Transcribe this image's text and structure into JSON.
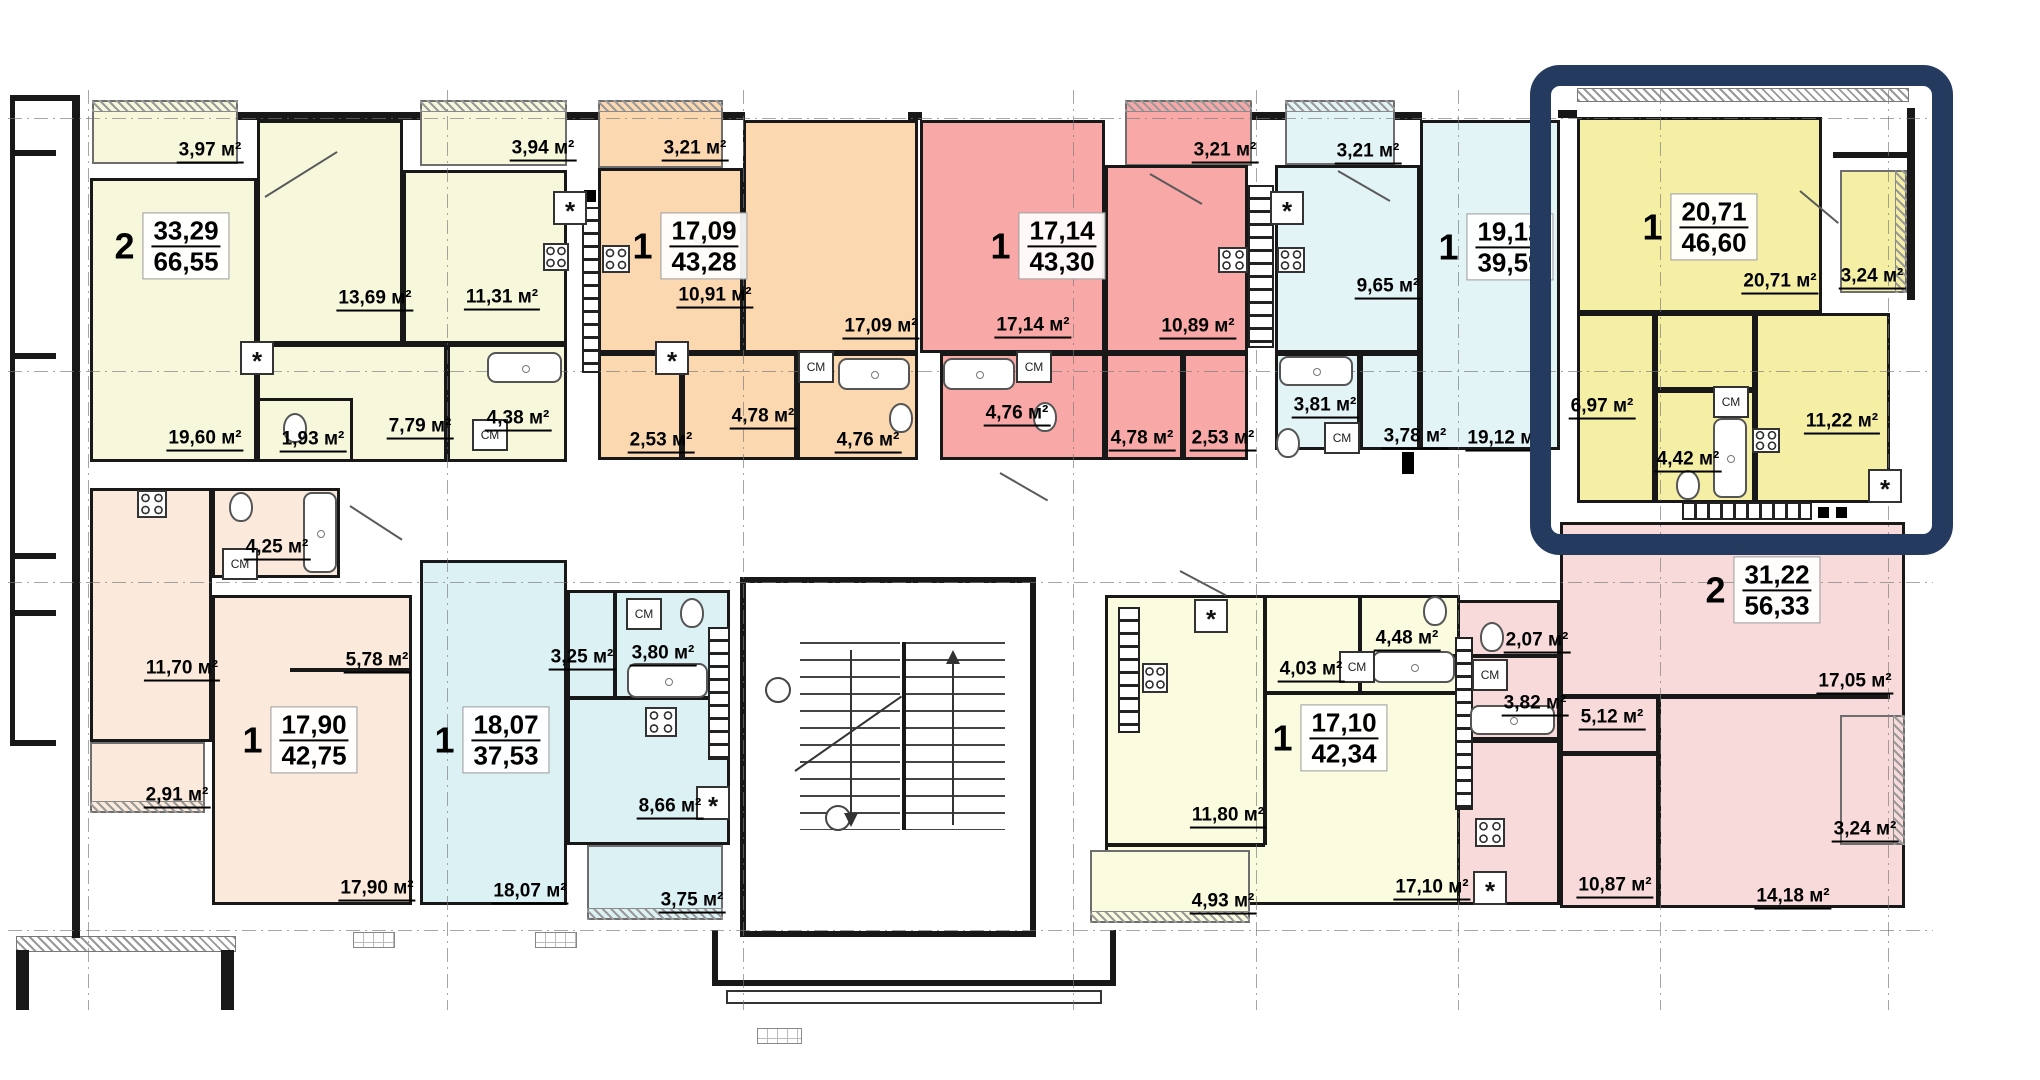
{
  "canvas": {
    "w": 2040,
    "h": 1080
  },
  "colors": {
    "cream": "#f7f7dc",
    "orange": "#fbd8b0",
    "pink": "#f9a8a8",
    "blue": "#e3f4f6",
    "yellow": "#f4efa5",
    "peach": "#fbeadc",
    "blue2": "#dbf1f4",
    "payell": "#fbfbdf",
    "pink2": "#f9dada",
    "wall": "#181818",
    "highlight": "#243a5e"
  },
  "highlight_box": {
    "x": 1530,
    "y": 65,
    "w": 423,
    "h": 490,
    "border": 21,
    "radius": 30
  },
  "units": [
    {
      "num": "2",
      "living": "33,29",
      "total": "66,55",
      "x": 172,
      "y": 246
    },
    {
      "num": "1",
      "living": "17,09",
      "total": "43,28",
      "x": 690,
      "y": 246
    },
    {
      "num": "1",
      "living": "17,14",
      "total": "43,30",
      "x": 1048,
      "y": 246
    },
    {
      "num": "1",
      "living": "19,12",
      "total": "39,59",
      "x": 1496,
      "y": 247
    },
    {
      "num": "1",
      "living": "20,71",
      "total": "46,60",
      "x": 1700,
      "y": 227
    },
    {
      "num": "2",
      "living": "31,22",
      "total": "56,33",
      "x": 1763,
      "y": 590
    },
    {
      "num": "1",
      "living": "17,90",
      "total": "42,75",
      "x": 300,
      "y": 740
    },
    {
      "num": "1",
      "living": "18,07",
      "total": "37,53",
      "x": 492,
      "y": 740
    },
    {
      "num": "1",
      "living": "17,10",
      "total": "42,34",
      "x": 1330,
      "y": 738
    }
  ],
  "room_fills": [
    {
      "r": [
        92,
        100,
        146,
        64
      ],
      "c": "cream",
      "hatch": "top"
    },
    {
      "r": [
        420,
        100,
        147,
        66
      ],
      "c": "cream",
      "hatch": "top"
    },
    {
      "r": [
        90,
        178,
        167,
        284
      ],
      "c": "cream"
    },
    {
      "r": [
        257,
        120,
        146,
        224
      ],
      "c": "cream"
    },
    {
      "r": [
        403,
        170,
        164,
        174
      ],
      "c": "cream"
    },
    {
      "r": [
        257,
        344,
        190,
        118
      ],
      "c": "cream"
    },
    {
      "r": [
        257,
        398,
        96,
        64
      ],
      "c": "cream"
    },
    {
      "r": [
        447,
        344,
        120,
        118
      ],
      "c": "cream"
    },
    {
      "r": [
        598,
        100,
        125,
        68
      ],
      "c": "orange",
      "hatch": "top"
    },
    {
      "r": [
        598,
        168,
        145,
        185
      ],
      "c": "orange"
    },
    {
      "r": [
        743,
        120,
        175,
        233
      ],
      "c": "orange"
    },
    {
      "r": [
        598,
        353,
        84,
        107
      ],
      "c": "orange"
    },
    {
      "r": [
        682,
        353,
        115,
        107
      ],
      "c": "orange"
    },
    {
      "r": [
        797,
        353,
        121,
        107
      ],
      "c": "orange"
    },
    {
      "r": [
        1125,
        100,
        127,
        66
      ],
      "c": "pink",
      "hatch": "top"
    },
    {
      "r": [
        920,
        120,
        185,
        233
      ],
      "c": "pink"
    },
    {
      "r": [
        1105,
        165,
        143,
        188
      ],
      "c": "pink"
    },
    {
      "r": [
        940,
        353,
        165,
        107
      ],
      "c": "pink"
    },
    {
      "r": [
        1105,
        353,
        78,
        107
      ],
      "c": "pink"
    },
    {
      "r": [
        1183,
        353,
        65,
        107
      ],
      "c": "pink"
    },
    {
      "r": [
        1285,
        100,
        110,
        65
      ],
      "c": "blue",
      "hatch": "top"
    },
    {
      "r": [
        1275,
        165,
        145,
        188
      ],
      "c": "blue"
    },
    {
      "r": [
        1420,
        120,
        140,
        330
      ],
      "c": "blue"
    },
    {
      "r": [
        1275,
        353,
        85,
        97
      ],
      "c": "blue"
    },
    {
      "r": [
        1360,
        353,
        60,
        97
      ],
      "c": "blue"
    },
    {
      "r": [
        1577,
        117,
        245,
        196
      ],
      "c": "yellow"
    },
    {
      "r": [
        1840,
        170,
        67,
        123
      ],
      "c": "yellow",
      "hatch": "right"
    },
    {
      "r": [
        1577,
        313,
        78,
        190
      ],
      "c": "yellow"
    },
    {
      "r": [
        1655,
        313,
        100,
        77
      ],
      "c": "yellow"
    },
    {
      "r": [
        1655,
        390,
        100,
        113
      ],
      "c": "yellow"
    },
    {
      "r": [
        1755,
        313,
        135,
        190
      ],
      "c": "yellow"
    },
    {
      "r": [
        1560,
        522,
        345,
        386
      ],
      "c": "pink2"
    },
    {
      "r": [
        1840,
        715,
        65,
        130
      ],
      "c": "pink2",
      "hatch": "right"
    },
    {
      "r": [
        1450,
        600,
        110,
        140
      ],
      "c": "pink2"
    },
    {
      "r": [
        1450,
        740,
        110,
        165
      ],
      "c": "pink2"
    },
    {
      "r": [
        90,
        488,
        122,
        254
      ],
      "c": "peach"
    },
    {
      "r": [
        90,
        742,
        115,
        71
      ],
      "c": "peach",
      "hatch": "bottom"
    },
    {
      "r": [
        212,
        488,
        128,
        90
      ],
      "c": "peach"
    },
    {
      "r": [
        212,
        595,
        200,
        310
      ],
      "c": "peach"
    },
    {
      "r": [
        420,
        560,
        147,
        345
      ],
      "c": "blue2"
    },
    {
      "r": [
        567,
        590,
        163,
        255
      ],
      "c": "blue2"
    },
    {
      "r": [
        587,
        845,
        136,
        75
      ],
      "c": "blue2",
      "hatch": "bottom"
    },
    {
      "r": [
        1105,
        595,
        355,
        310
      ],
      "c": "payell"
    },
    {
      "r": [
        1090,
        850,
        160,
        73
      ],
      "c": "payell",
      "hatch": "bottom"
    }
  ],
  "area_labels": [
    {
      "t": "3,97 м²",
      "x": 210,
      "y": 152
    },
    {
      "t": "3,94 м²",
      "x": 543,
      "y": 150
    },
    {
      "t": "13,69 м²",
      "x": 375,
      "y": 300
    },
    {
      "t": "11,31 м²",
      "x": 502,
      "y": 299
    },
    {
      "t": "19,60 м²",
      "x": 205,
      "y": 440
    },
    {
      "t": "1,93 м²",
      "x": 313,
      "y": 441
    },
    {
      "t": "7,79 м²",
      "x": 420,
      "y": 428
    },
    {
      "t": "4,38 м²",
      "x": 518,
      "y": 420
    },
    {
      "t": "3,21 м²",
      "x": 695,
      "y": 150
    },
    {
      "t": "10,91 м²",
      "x": 715,
      "y": 297
    },
    {
      "t": "17,09 м²",
      "x": 881,
      "y": 328
    },
    {
      "t": "4,78 м²",
      "x": 763,
      "y": 418
    },
    {
      "t": "2,53 м²",
      "x": 661,
      "y": 442
    },
    {
      "t": "4,76 м²",
      "x": 868,
      "y": 442
    },
    {
      "t": "3,21 м²",
      "x": 1225,
      "y": 152
    },
    {
      "t": "17,14 м²",
      "x": 1033,
      "y": 327
    },
    {
      "t": "10,89 м²",
      "x": 1198,
      "y": 328
    },
    {
      "t": "4,78 м²",
      "x": 1142,
      "y": 440
    },
    {
      "t": "2,53 м²",
      "x": 1223,
      "y": 440
    },
    {
      "t": "4,76 м²",
      "x": 1017,
      "y": 415
    },
    {
      "t": "3,21 м²",
      "x": 1368,
      "y": 153
    },
    {
      "t": "9,65 м²",
      "x": 1388,
      "y": 288
    },
    {
      "t": "3,81 м²",
      "x": 1325,
      "y": 407
    },
    {
      "t": "3,78 м²",
      "x": 1415,
      "y": 438
    },
    {
      "t": "19,12 м²",
      "x": 1504,
      "y": 440
    },
    {
      "t": "20,71 м²",
      "x": 1780,
      "y": 283
    },
    {
      "t": "3,24 м²",
      "x": 1872,
      "y": 278
    },
    {
      "t": "6,97 м²",
      "x": 1602,
      "y": 408
    },
    {
      "t": "4,42 м²",
      "x": 1688,
      "y": 461
    },
    {
      "t": "11,22 м²",
      "x": 1842,
      "y": 423
    },
    {
      "t": "17,05 м²",
      "x": 1855,
      "y": 683
    },
    {
      "t": "5,12 м²",
      "x": 1612,
      "y": 719
    },
    {
      "t": "2,07 м²",
      "x": 1537,
      "y": 642
    },
    {
      "t": "3,82 м²",
      "x": 1535,
      "y": 705
    },
    {
      "t": "3,24 м²",
      "x": 1865,
      "y": 831
    },
    {
      "t": "10,87 м²",
      "x": 1615,
      "y": 887
    },
    {
      "t": "14,18 м²",
      "x": 1793,
      "y": 898
    },
    {
      "t": "11,70 м²",
      "x": 182,
      "y": 670
    },
    {
      "t": "4,25 м²",
      "x": 277,
      "y": 549
    },
    {
      "t": "5,78 м²",
      "x": 377,
      "y": 662
    },
    {
      "t": "2,91 м²",
      "x": 177,
      "y": 797
    },
    {
      "t": "17,90 м²",
      "x": 377,
      "y": 890
    },
    {
      "t": "3,25 м²",
      "x": 582,
      "y": 659
    },
    {
      "t": "3,80 м²",
      "x": 663,
      "y": 655
    },
    {
      "t": "8,66 м²",
      "x": 670,
      "y": 808
    },
    {
      "t": "3,75 м²",
      "x": 692,
      "y": 902
    },
    {
      "t": "18,07 м²",
      "x": 530,
      "y": 893
    },
    {
      "t": "11,80 м²",
      "x": 1228,
      "y": 817
    },
    {
      "t": "4,03 м²",
      "x": 1311,
      "y": 671
    },
    {
      "t": "4,48 м²",
      "x": 1407,
      "y": 640
    },
    {
      "t": "17,10 м²",
      "x": 1432,
      "y": 889
    },
    {
      "t": "4,93 м²",
      "x": 1223,
      "y": 903
    }
  ],
  "plan_texts": {
    "cm": "СМ",
    "star": "*"
  },
  "cm_labels": [
    {
      "x": 490,
      "y": 435
    },
    {
      "x": 816,
      "y": 367
    },
    {
      "x": 1034,
      "y": 367
    },
    {
      "x": 1342,
      "y": 438
    },
    {
      "x": 1731,
      "y": 402
    },
    {
      "x": 1490,
      "y": 675
    },
    {
      "x": 240,
      "y": 564
    },
    {
      "x": 644,
      "y": 614
    },
    {
      "x": 1357,
      "y": 667
    }
  ],
  "stars": [
    {
      "x": 570,
      "y": 208
    },
    {
      "x": 257,
      "y": 358
    },
    {
      "x": 672,
      "y": 358
    },
    {
      "x": 1287,
      "y": 208
    },
    {
      "x": 1885,
      "y": 486
    },
    {
      "x": 1490,
      "y": 888
    },
    {
      "x": 713,
      "y": 803
    },
    {
      "x": 1211,
      "y": 616
    }
  ],
  "walls": [
    [
      72,
      95,
      8,
      707
    ],
    [
      10,
      95,
      66,
      6
    ],
    [
      10,
      150,
      46,
      6
    ],
    [
      10,
      353,
      46,
      6
    ],
    [
      10,
      95,
      5,
      470
    ],
    [
      10,
      553,
      5,
      192
    ],
    [
      10,
      553,
      46,
      6
    ],
    [
      10,
      610,
      46,
      6
    ],
    [
      10,
      740,
      46,
      6
    ],
    [
      72,
      800,
      8,
      138
    ],
    [
      16,
      950,
      13,
      60
    ],
    [
      221,
      950,
      13,
      60
    ],
    [
      238,
      112,
      182,
      8
    ],
    [
      567,
      112,
      31,
      8
    ],
    [
      723,
      112,
      22,
      8
    ],
    [
      908,
      112,
      14,
      8
    ],
    [
      1252,
      112,
      33,
      8
    ],
    [
      1395,
      112,
      27,
      8
    ],
    [
      1558,
      110,
      19,
      8
    ],
    [
      1907,
      108,
      8,
      192
    ],
    [
      1833,
      152,
      74,
      6
    ],
    [
      1560,
      694,
      330,
      5
    ],
    [
      1656,
      694,
      5,
      214
    ],
    [
      1560,
      751,
      98,
      5
    ],
    [
      1450,
      654,
      110,
      4
    ],
    [
      1263,
      595,
      4,
      250
    ],
    [
      1263,
      691,
      192,
      4
    ],
    [
      1358,
      595,
      4,
      96
    ],
    [
      1105,
      843,
      160,
      4
    ],
    [
      613,
      590,
      4,
      108
    ],
    [
      567,
      696,
      163,
      4
    ],
    [
      290,
      668,
      122,
      4
    ],
    [
      712,
      930,
      6,
      56
    ],
    [
      1110,
      930,
      6,
      56
    ],
    [
      712,
      980,
      404,
      6
    ]
  ],
  "hatchbands": [
    [
      1577,
      88,
      330,
      12
    ],
    [
      16,
      936,
      218,
      14
    ]
  ],
  "cabinets": [
    {
      "r": [
        582,
        207,
        18,
        166
      ],
      "o": "v"
    },
    {
      "r": [
        1248,
        185,
        26,
        163
      ],
      "o": "v"
    },
    {
      "r": [
        1118,
        607,
        22,
        126
      ],
      "o": "v"
    },
    {
      "r": [
        1455,
        637,
        18,
        173
      ],
      "o": "v"
    },
    {
      "r": [
        708,
        627,
        22,
        133
      ],
      "o": "v"
    },
    {
      "r": [
        1682,
        502,
        130,
        18
      ],
      "o": "h"
    }
  ],
  "fixtures": {
    "tubs": [
      [
        487,
        352,
        75,
        31
      ],
      [
        838,
        358,
        72,
        32
      ],
      [
        943,
        358,
        72,
        32
      ],
      [
        1279,
        356,
        74,
        30
      ],
      [
        1713,
        418,
        34,
        80
      ],
      [
        1470,
        705,
        85,
        30
      ],
      [
        303,
        492,
        34,
        81
      ],
      [
        627,
        663,
        81,
        35
      ],
      [
        1372,
        651,
        83,
        32
      ]
    ],
    "wcs": [
      [
        295,
        428
      ],
      [
        901,
        418
      ],
      [
        1045,
        417
      ],
      [
        1288,
        443
      ],
      [
        1688,
        485
      ],
      [
        1492,
        637
      ],
      [
        241,
        507
      ],
      [
        692,
        613
      ],
      [
        1435,
        611
      ]
    ],
    "stoves": [
      [
        543,
        243,
        26,
        28
      ],
      [
        602,
        245,
        28,
        28
      ],
      [
        1218,
        247,
        30,
        26
      ],
      [
        1277,
        247,
        28,
        26
      ],
      [
        1752,
        428,
        28,
        25
      ],
      [
        1475,
        818,
        30,
        29
      ],
      [
        137,
        490,
        30,
        28
      ],
      [
        645,
        707,
        32,
        30
      ],
      [
        1142,
        663,
        26,
        30
      ]
    ]
  },
  "black_boxes": [
    [
      1402,
      452,
      12,
      22
    ],
    [
      584,
      190,
      12,
      12
    ],
    [
      1818,
      507,
      11,
      11
    ],
    [
      1836,
      507,
      11,
      11
    ]
  ],
  "pads": [
    [
      353,
      932,
      42,
      16
    ],
    [
      535,
      932,
      42,
      16
    ],
    [
      757,
      1028,
      45,
      16
    ]
  ],
  "doors": [
    [
      265,
      196,
      85,
      -32
    ],
    [
      672,
      225,
      70,
      32
    ],
    [
      1150,
      173,
      60,
      30
    ],
    [
      1338,
      170,
      60,
      30
    ],
    [
      1800,
      190,
      50,
      40
    ],
    [
      350,
      505,
      62,
      33
    ],
    [
      1000,
      472,
      55,
      30
    ],
    [
      1180,
      570,
      52,
      28
    ]
  ],
  "stair": {
    "box": [
      740,
      577,
      296,
      360
    ],
    "flights": [
      [
        800,
        642,
        100,
        188
      ],
      [
        905,
        642,
        100,
        188
      ]
    ],
    "divider": [
      902,
      642,
      4,
      188
    ],
    "circles": [
      [
        778,
        690
      ],
      [
        838,
        818
      ]
    ],
    "slash": [
      795,
      770,
      130,
      -35
    ],
    "arrow_up": [
      952,
      650,
      175
    ],
    "arrow_down": [
      850,
      650,
      175
    ]
  },
  "entrance": {
    "platform": [
      726,
      990,
      376,
      14
    ]
  },
  "axes": {
    "v": [
      88,
      447,
      743,
      1073,
      1256,
      1458,
      1660,
      1888
    ],
    "h": [
      118,
      371,
      582,
      930
    ]
  }
}
